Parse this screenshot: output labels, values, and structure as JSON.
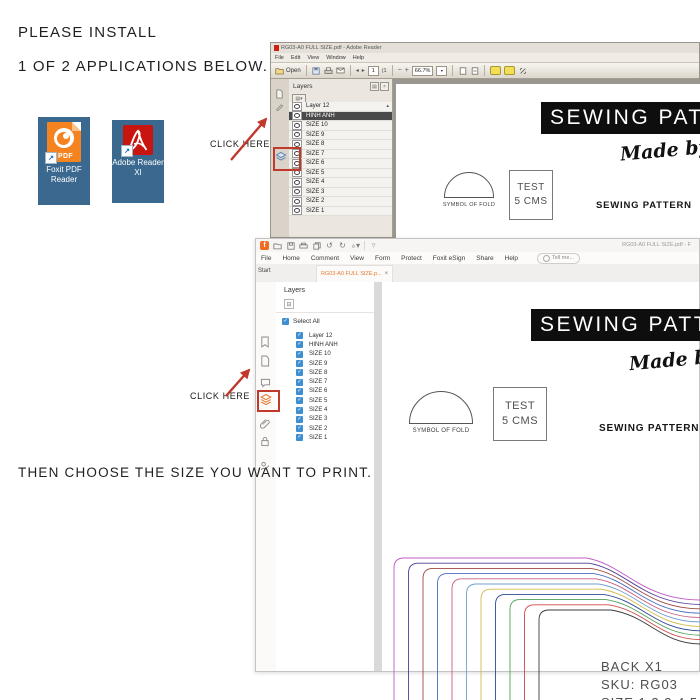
{
  "instructions": {
    "install_line1": "PLEASE INSTALL",
    "install_line2": "1 OF 2 APPLICATIONS BELOW.",
    "click_here_adobe": "CLICK HERE",
    "click_here_foxit": "CLICK HERE",
    "choose_size": "THEN CHOOSE THE SIZE YOU WANT TO PRINT."
  },
  "desktop": {
    "icons": [
      {
        "label": "Foxit PDF Reader",
        "badge": "PDF",
        "icon_color": "#f5831f",
        "tile_color": "#3a688e"
      },
      {
        "label": "Adobe Reader XI",
        "icon_color": "#c9150f",
        "tile_color": "#3a688e"
      }
    ]
  },
  "adobe_reader": {
    "window_title": "RG03-A0 FULL SIZE.pdf - Adobe Reader",
    "menu_items": [
      "File",
      "Edit",
      "View",
      "Window",
      "Help"
    ],
    "toolbar": {
      "open_label": "Open",
      "page_number": "1",
      "page_count": "(1",
      "zoom_level": "66.7%"
    },
    "layers_panel": {
      "title": "Layers",
      "selected_layer": "HINH ANH",
      "layers": [
        "Layer 12",
        "HINH ANH",
        "SIZE 10",
        "SIZE 9",
        "SIZE 8",
        "SIZE 7",
        "SIZE 6",
        "SIZE 5",
        "SIZE 4",
        "SIZE 3",
        "SIZE 2",
        "SIZE 1"
      ]
    }
  },
  "foxit_reader": {
    "window_title": "RG03-A0 FULL SIZE.pdf - F",
    "menu_items": [
      "File",
      "Home",
      "Comment",
      "View",
      "Form",
      "Protect",
      "Foxit eSign",
      "Share",
      "Help"
    ],
    "search_label": "Tell me...",
    "tabs": [
      {
        "label": "Start",
        "active": false
      },
      {
        "label": "RG03-A0 FULL SIZE.p...",
        "close": "×",
        "active": true
      }
    ],
    "layers_panel": {
      "title": "Layers",
      "select_all_label": "Select All",
      "all_checked": true,
      "checkbox_color": "#3d8fd1",
      "layers": [
        "Layer 12",
        "HINH ANH",
        "SIZE 10",
        "SIZE 9",
        "SIZE 8",
        "SIZE 7",
        "SIZE 6",
        "SIZE 5",
        "SIZE 4",
        "SIZE 3",
        "SIZE 2",
        "SIZE 1"
      ]
    }
  },
  "pdf_document": {
    "banner_title": "SEWING PATTERN",
    "made_by": "Made by B",
    "fold_label": "SYMBOL OF FOLD",
    "test_box_line1": "TEST",
    "test_box_line2": "5 CMS",
    "subtitle": "SEWING PATTERN"
  },
  "pattern": {
    "label_piece": "BACK X1",
    "label_sku": "SKU: RG03",
    "label_sizes": "SIZE:1,2,3,4,5,6,7",
    "curve_colors": [
      "#c25cc2",
      "#4f3e96",
      "#9c4a42",
      "#4a6cc0",
      "#c95c85",
      "#6fa0d0",
      "#d4ba4a",
      "#2d4a94",
      "#4fa057",
      "#d24848",
      "#3b3b3b"
    ]
  },
  "annotation_color": "#c0392b"
}
